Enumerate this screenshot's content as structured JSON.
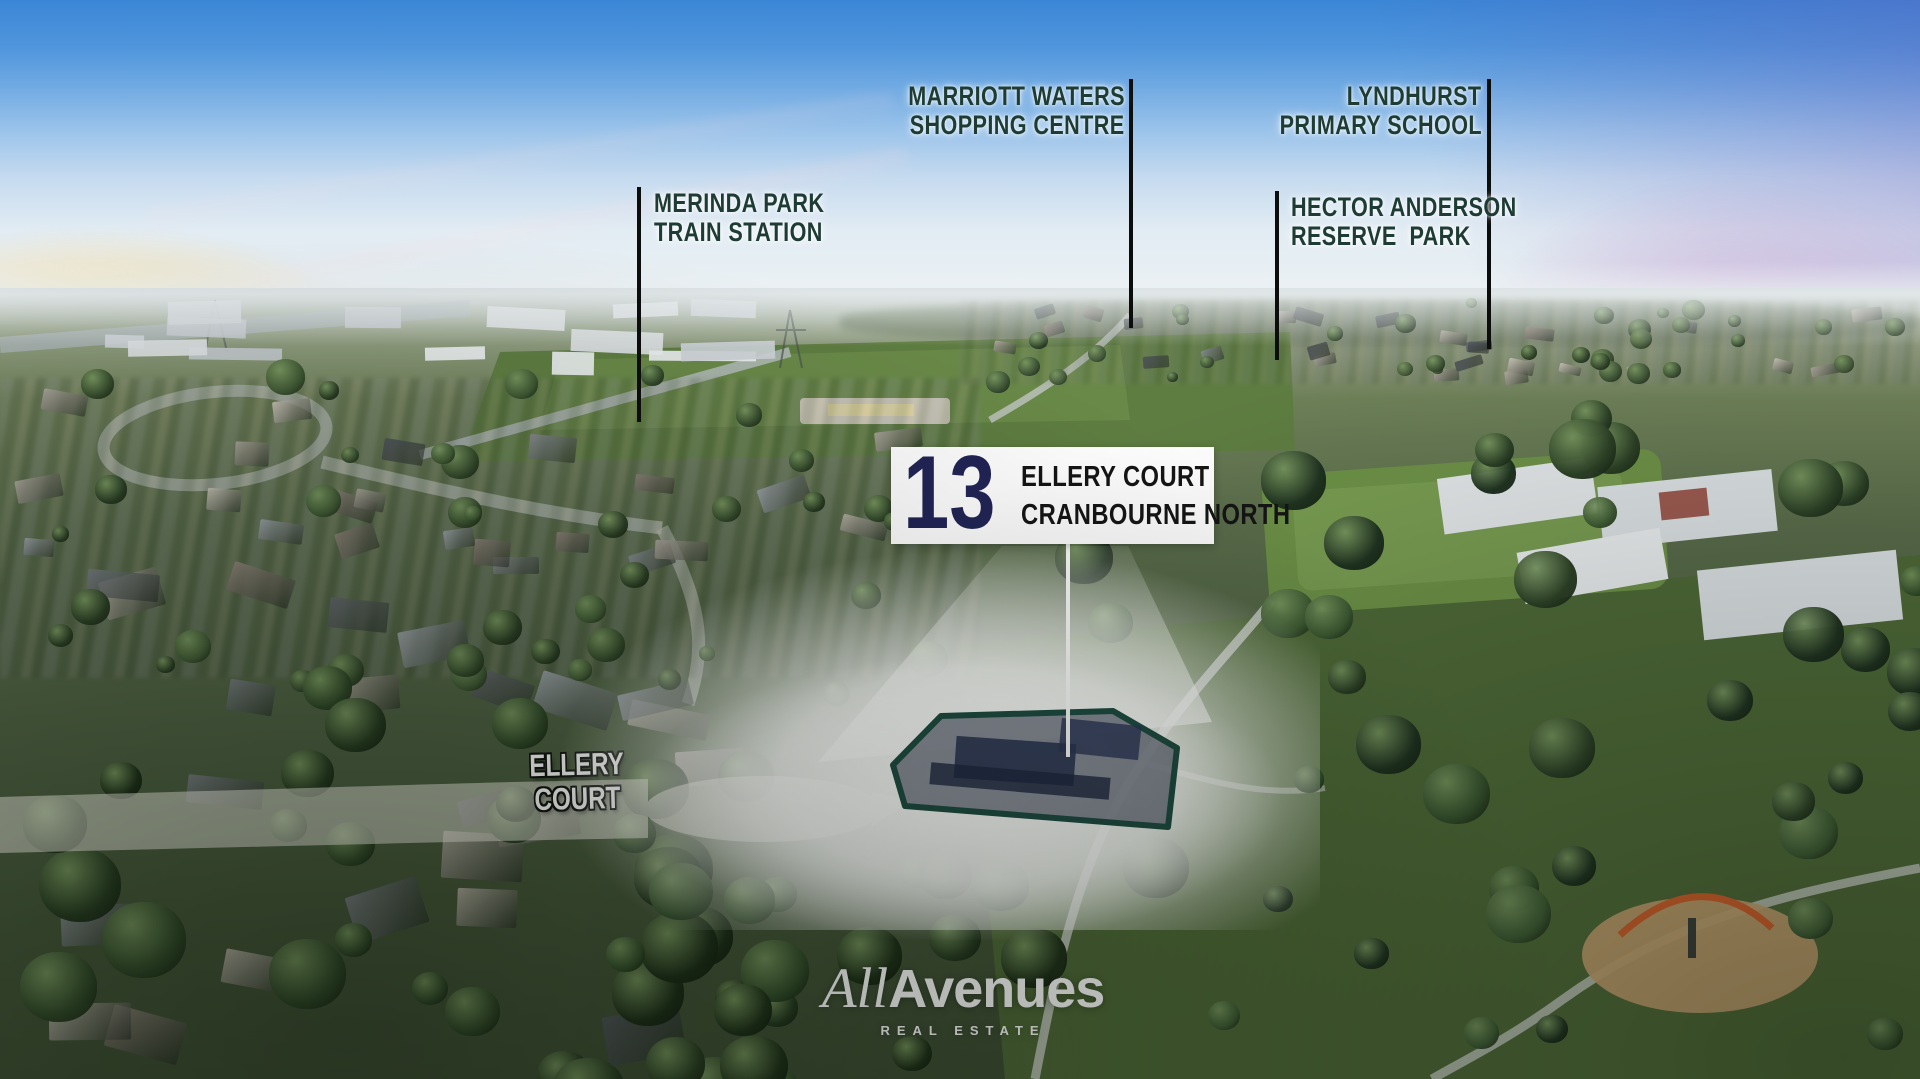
{
  "landmarks": [
    {
      "id": "marriott",
      "line1": "MARRIOTT WATERS",
      "line2": "SHOPPING CENTRE"
    },
    {
      "id": "lyndhurst",
      "line1": "LYNDHURST",
      "line2": "PRIMARY SCHOOL"
    },
    {
      "id": "merinda",
      "line1": "MERINDA PARK",
      "line2": "TRAIN STATION"
    },
    {
      "id": "hector",
      "line1": "HECTOR ANDERSON",
      "line2": "RESERVE  PARK"
    }
  ],
  "property": {
    "number": "13",
    "street": "ELLERY COURT",
    "suburb": "CRANBOURNE NORTH"
  },
  "street_label": {
    "text": "ELLERY COURT"
  },
  "logo": {
    "part1": "All",
    "part2": "Avenues",
    "tagline": "REAL ESTATE"
  },
  "colors": {
    "label_green": "#1e3c33",
    "address_navy": "#212456",
    "pointer_black": "#0c0d0d",
    "boundary_teal": "#1d4b41",
    "white": "#ffffff"
  }
}
